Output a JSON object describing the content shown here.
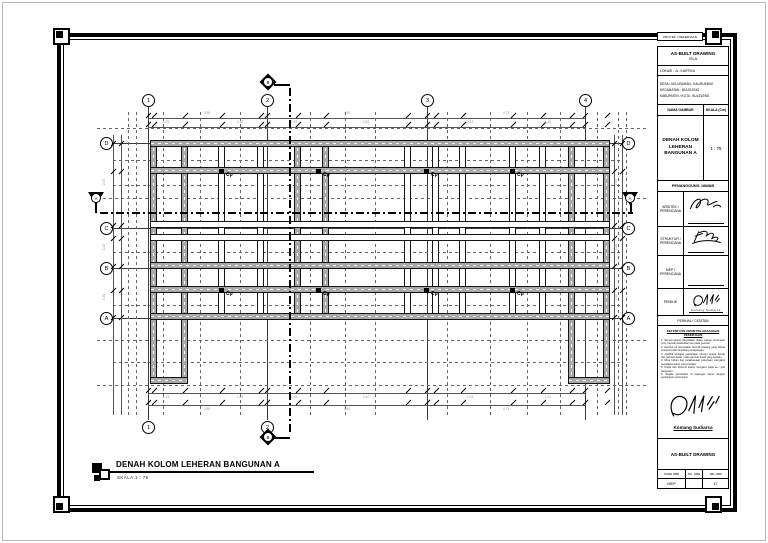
{
  "sheet": {
    "drawing_title": "DENAH KOLOM LEHERAN BANGUNAN A",
    "drawing_scale": "SKALA  1 : 75"
  },
  "grid": {
    "top": [
      "1",
      "2",
      "3",
      "4"
    ],
    "bottom": [
      "1",
      "2"
    ],
    "left": [
      "D",
      "C",
      "B",
      "A"
    ],
    "right": [
      "D",
      "C",
      "B",
      "A"
    ]
  },
  "plan": {
    "column_label": "Cp",
    "section_label_vertical": "B",
    "section_label_horizontal": "A"
  },
  "dimensions": {
    "top_major": [
      "3.58",
      "4.80",
      "4.73"
    ],
    "top_minor": [
      "1.05",
      "1.18",
      "2.45",
      "0.83",
      "2.33",
      "1.28"
    ],
    "bottom_major": [
      "3.58",
      "4.80",
      "4.73"
    ],
    "bottom_minor": [
      "1.13",
      "1.05",
      "2.48",
      "2.40",
      "1.05",
      "1.13"
    ],
    "side": [
      "2.55",
      "1.20",
      "1.50"
    ]
  },
  "titleblock": {
    "project_header": "PROYEK / PEKERJAAN",
    "project_name": "AS-BUILT DRAWING",
    "project_sub": "VILA",
    "location": "LOKASI : JL. KARTIKA",
    "address_lines": [
      "DESA / KELURAHAN : KALIBUKBUK",
      "KECAMATAN : BULELENG",
      "KABUPATEN / KOTA : BULELENG"
    ],
    "drawing_name_header": "NAMA GAMBAR",
    "scale_header": "SKALA (Cm)",
    "drawing_name": "DENAH KOLOM LEHERAN BANGUNAN A",
    "scale_value": "1 : 75",
    "responsibility_header": "PENANGGUNG JAWAB",
    "signatories": [
      {
        "role": "ARSITEK / PERENCANA",
        "name": "·······················"
      },
      {
        "role": "STRUKTUR / PERENCANA",
        "name": "·······················"
      },
      {
        "role": "MEP / PERENCANA",
        "name": "·······················"
      },
      {
        "role": "PEMILIK",
        "name": "Komang Sudiarsa"
      }
    ],
    "notes_header": "PERIHAL / CATATAN",
    "notes_title": "KETENTUAN UMUM PELAKSANAAN PEKERJAAN",
    "notes_lines": [
      "1. Semua ukuran dinyatakan dalam satuan centimeter (cm), kecuali disebutkan lain pada gambar.",
      "2. Gambar ini merupakan as-built drawing yang dibuat sesuai kondisi terpasang di lapangan.",
      "3. Apabila terdapat perbedaan ukuran antara denah dan gambar detail, maka gambar detail yang berlaku.",
      "4. Mutu bahan dan pelaksanaan pekerjaan mengikuti spesifikasi teknis yang berlaku.",
      "5. Posisi dan dimensi kolom mengacu pada as / grid bangunan.",
      "6. Segala perubahan di lapangan harus dengan persetujuan perencana."
    ],
    "owner_name": "Komang Sudiarsa",
    "owner_subtitle": "····················",
    "footer_title": "AS-BUILT DRAWING",
    "footer_headers": [
      "KODE GBR",
      "NO. GBR",
      "JML GBR"
    ],
    "footer_values": [
      "MEP",
      "",
      "17"
    ]
  }
}
